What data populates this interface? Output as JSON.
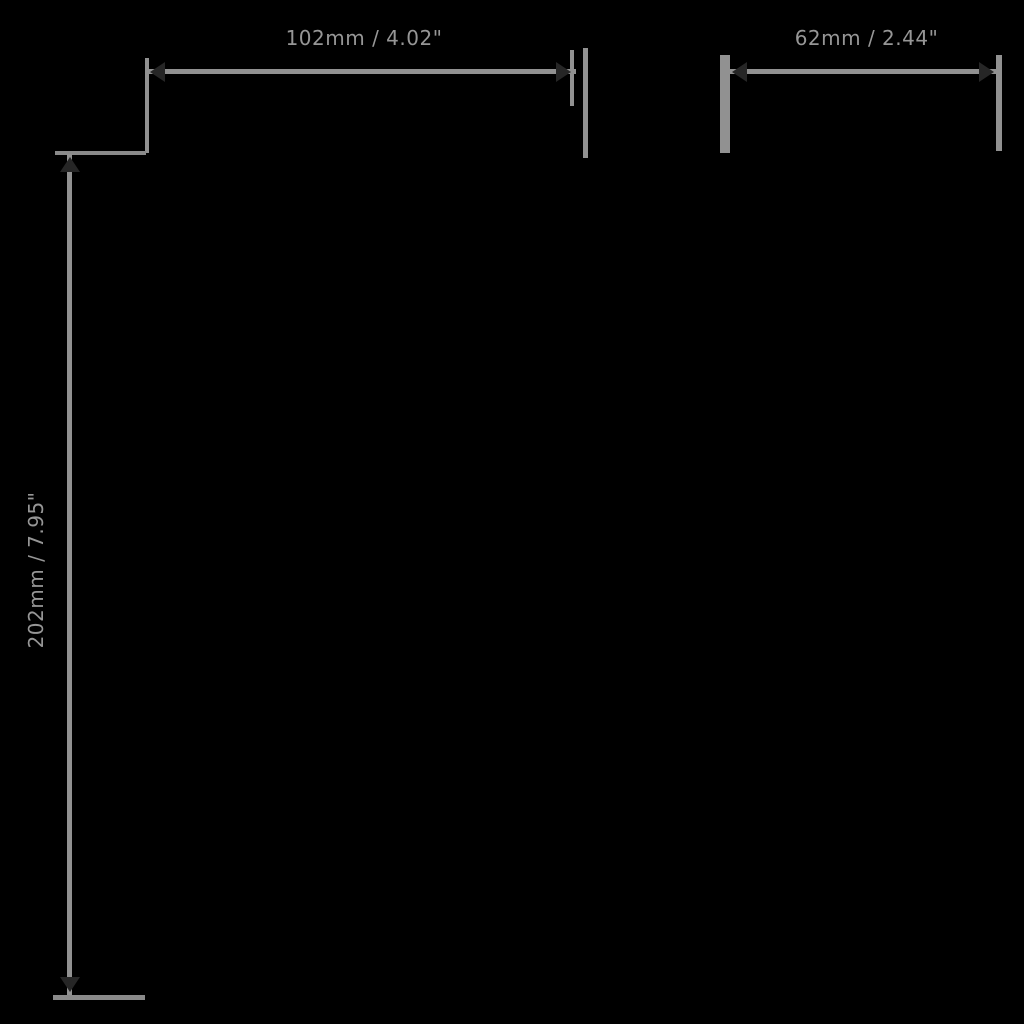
{
  "page": {
    "background_color": "#000000",
    "line_color": "#919191",
    "arrow_color": "#262626",
    "label_color": "#969696"
  },
  "dimensions": {
    "horizontal_primary": {
      "label": "102mm / 4.02\""
    },
    "horizontal_secondary": {
      "label": "62mm / 2.44\""
    },
    "vertical": {
      "label": "202mm / 7.95\""
    }
  }
}
